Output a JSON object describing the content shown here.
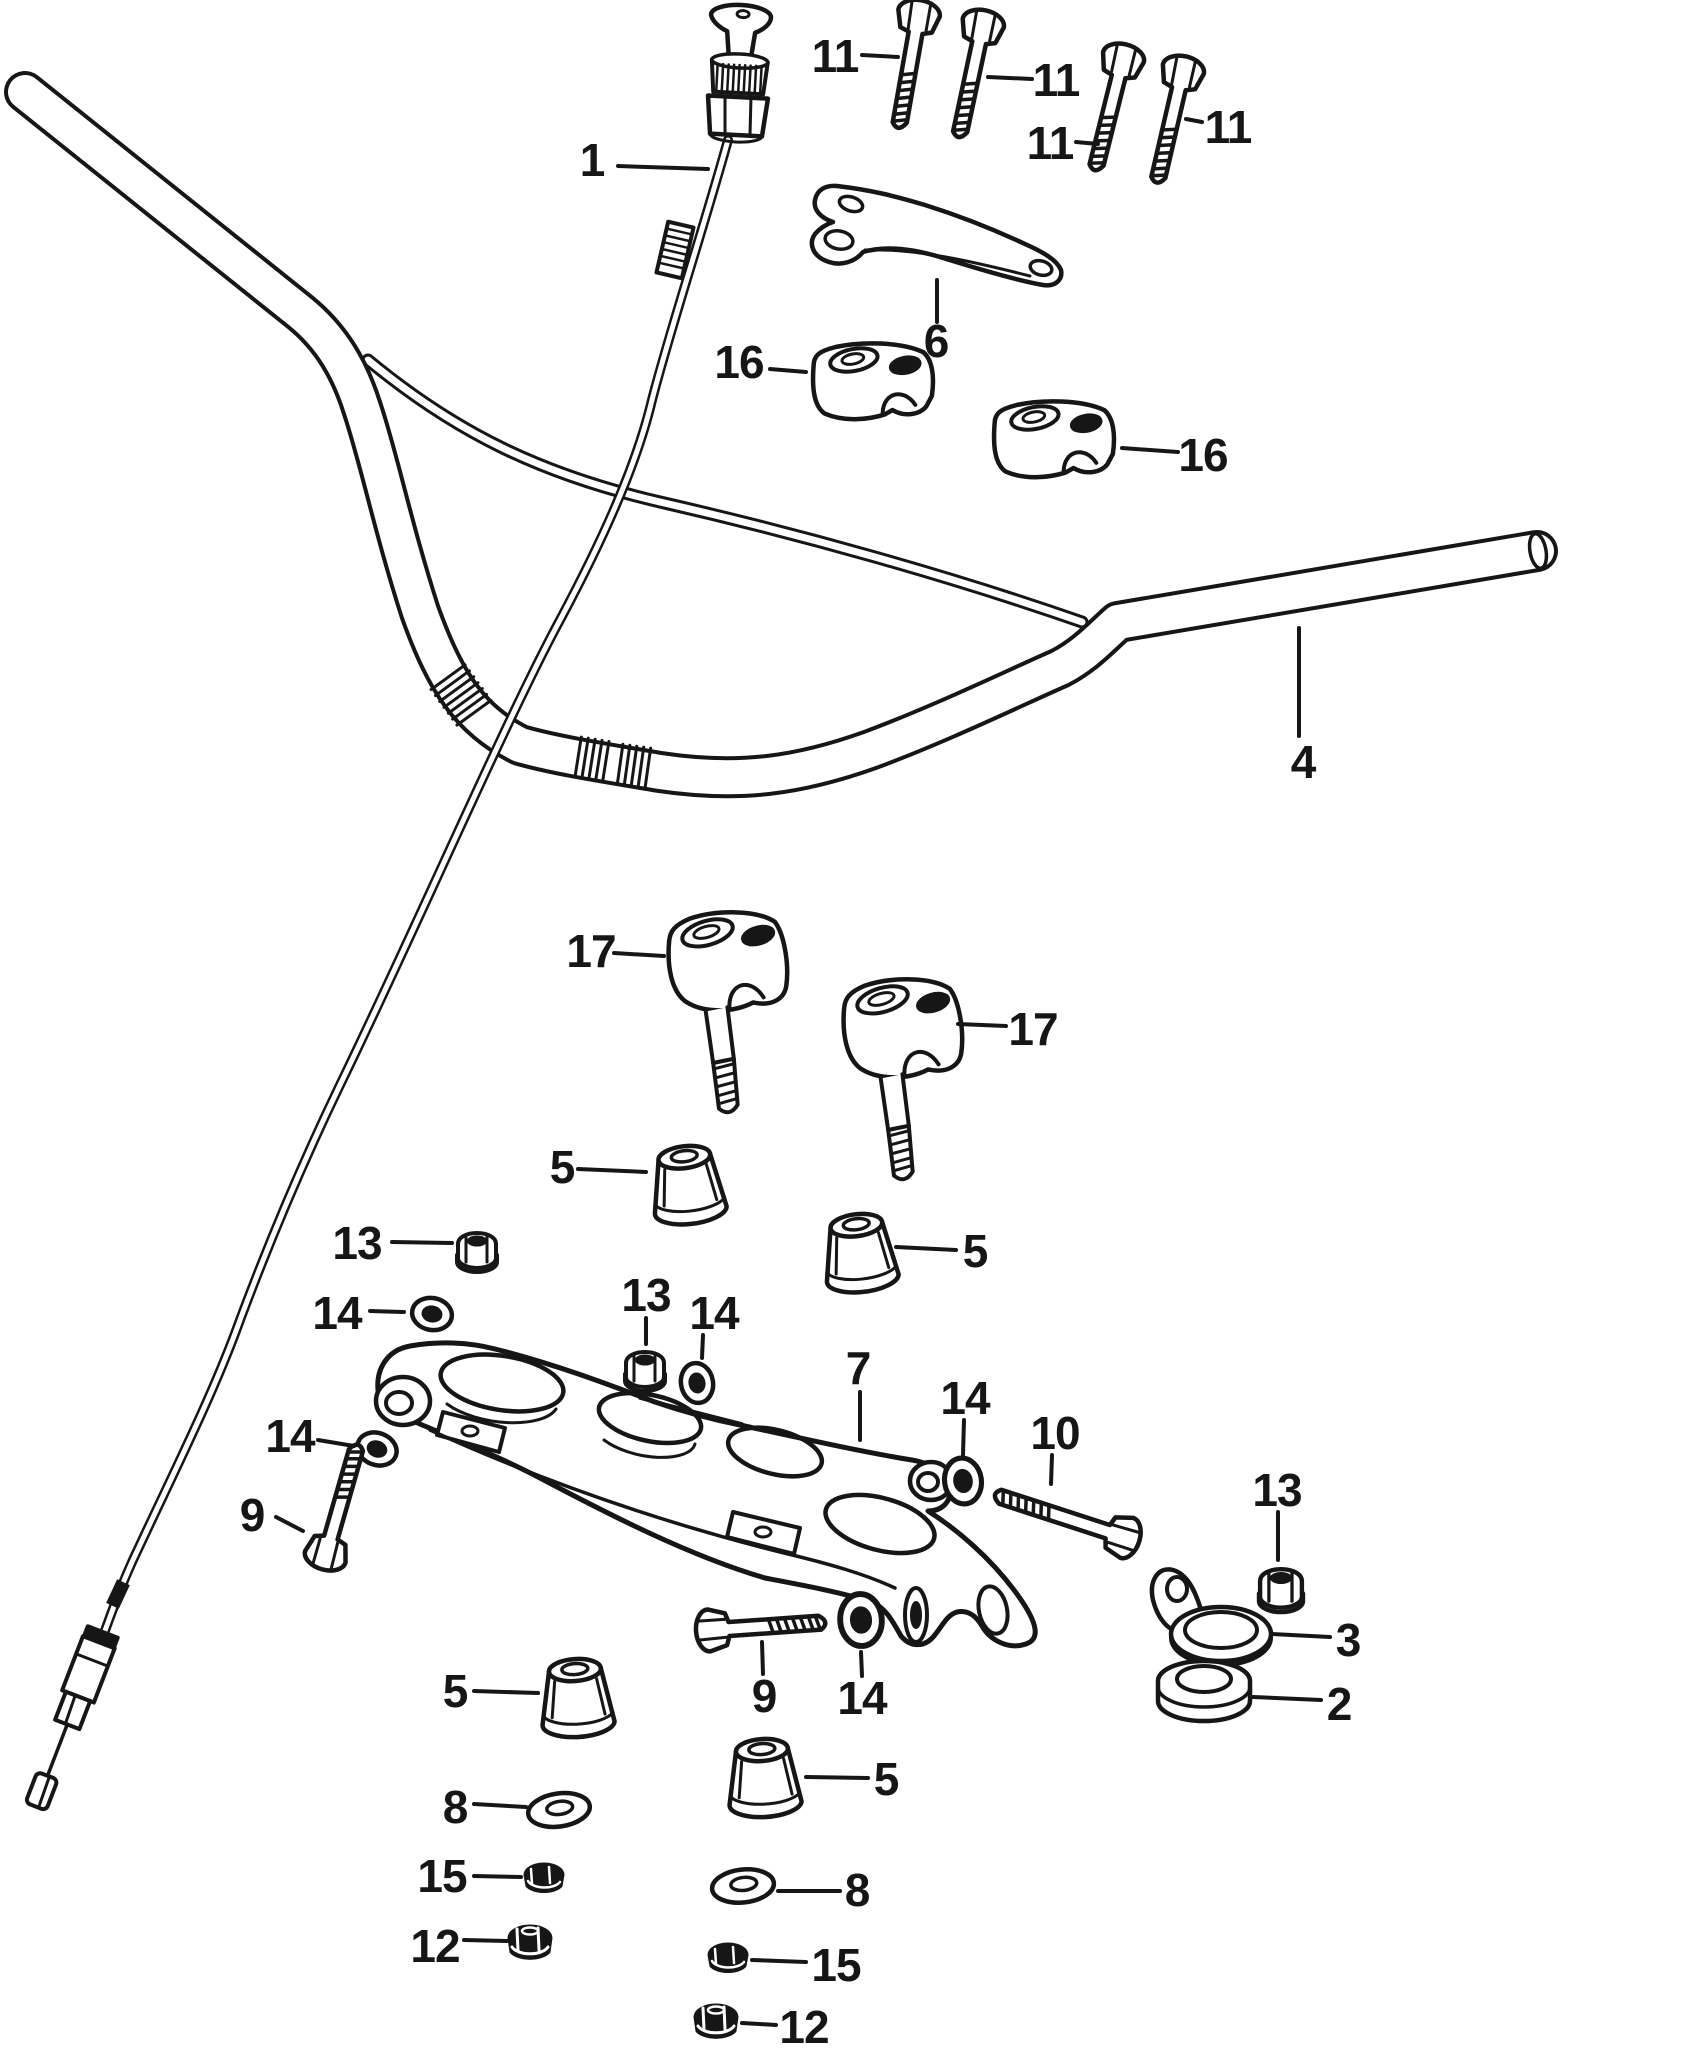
{
  "diagram": {
    "type": "exploded-parts-diagram",
    "subject": "motorcycle handlebar assembly",
    "canvas": {
      "width": 1700,
      "height": 2053,
      "background": "#ffffff",
      "ink": "#161616"
    },
    "label_style": {
      "font_size": 46,
      "font_weight": "bold",
      "leader_width": 4
    },
    "part_numbers_visible": [
      "1",
      "2",
      "3",
      "4",
      "5",
      "6",
      "7",
      "8",
      "9",
      "10",
      "11",
      "12",
      "13",
      "14",
      "15",
      "16",
      "17"
    ],
    "labels": [
      {
        "part": "1",
        "x": 592,
        "y": 160,
        "leader": [
          618,
          166,
          708,
          169
        ]
      },
      {
        "part": "11",
        "x": 835,
        "y": 56,
        "leader": [
          862,
          55,
          898,
          57
        ]
      },
      {
        "part": "11",
        "x": 1056,
        "y": 80,
        "leader": [
          1032,
          79,
          988,
          77
        ]
      },
      {
        "part": "11",
        "x": 1050,
        "y": 143,
        "leader": [
          1076,
          142,
          1098,
          144
        ]
      },
      {
        "part": "11",
        "x": 1228,
        "y": 127,
        "leader": [
          1202,
          122,
          1186,
          119
        ]
      },
      {
        "part": "6",
        "x": 936,
        "y": 341,
        "leader": [
          937,
          322,
          937,
          280
        ]
      },
      {
        "part": "16",
        "x": 739,
        "y": 362,
        "leader": [
          770,
          369,
          806,
          372
        ]
      },
      {
        "part": "16",
        "x": 1203,
        "y": 455,
        "leader": [
          1178,
          452,
          1122,
          448
        ]
      },
      {
        "part": "4",
        "x": 1303,
        "y": 762,
        "leader": [
          1299,
          736,
          1299,
          628
        ]
      },
      {
        "part": "17",
        "x": 591,
        "y": 951,
        "leader": [
          614,
          953,
          664,
          956
        ]
      },
      {
        "part": "17",
        "x": 1033,
        "y": 1029,
        "leader": [
          1006,
          1026,
          958,
          1024
        ]
      },
      {
        "part": "5",
        "x": 562,
        "y": 1167,
        "leader": [
          578,
          1169,
          646,
          1172
        ]
      },
      {
        "part": "5",
        "x": 975,
        "y": 1251,
        "leader": [
          956,
          1250,
          896,
          1247
        ]
      },
      {
        "part": "13",
        "x": 357,
        "y": 1243,
        "leader": [
          392,
          1242,
          452,
          1243
        ]
      },
      {
        "part": "14",
        "x": 337,
        "y": 1313,
        "leader": [
          370,
          1311,
          404,
          1312
        ]
      },
      {
        "part": "13",
        "x": 646,
        "y": 1295,
        "leader": [
          646,
          1318,
          646,
          1344
        ]
      },
      {
        "part": "14",
        "x": 714,
        "y": 1313,
        "leader": [
          703,
          1335,
          702,
          1358
        ]
      },
      {
        "part": "7",
        "x": 858,
        "y": 1368,
        "leader": [
          860,
          1392,
          860,
          1440
        ]
      },
      {
        "part": "14",
        "x": 965,
        "y": 1398,
        "leader": [
          964,
          1420,
          963,
          1455
        ]
      },
      {
        "part": "10",
        "x": 1055,
        "y": 1433,
        "leader": [
          1052,
          1455,
          1051,
          1484
        ]
      },
      {
        "part": "14",
        "x": 290,
        "y": 1436,
        "leader": [
          318,
          1440,
          354,
          1446
        ]
      },
      {
        "part": "9",
        "x": 252,
        "y": 1515,
        "leader": [
          276,
          1517,
          303,
          1531
        ]
      },
      {
        "part": "13",
        "x": 1277,
        "y": 1490,
        "leader": [
          1278,
          1512,
          1278,
          1560
        ]
      },
      {
        "part": "3",
        "x": 1348,
        "y": 1640,
        "leader": [
          1330,
          1637,
          1272,
          1634
        ]
      },
      {
        "part": "2",
        "x": 1339,
        "y": 1704,
        "leader": [
          1321,
          1700,
          1253,
          1697
        ]
      },
      {
        "part": "5",
        "x": 455,
        "y": 1691,
        "leader": [
          474,
          1691,
          538,
          1693
        ]
      },
      {
        "part": "9",
        "x": 764,
        "y": 1696,
        "leader": [
          763,
          1674,
          762,
          1642
        ]
      },
      {
        "part": "14",
        "x": 862,
        "y": 1698,
        "leader": [
          862,
          1676,
          861,
          1652
        ]
      },
      {
        "part": "5",
        "x": 886,
        "y": 1779,
        "leader": [
          868,
          1778,
          806,
          1777
        ]
      },
      {
        "part": "8",
        "x": 455,
        "y": 1807,
        "leader": [
          474,
          1804,
          526,
          1807
        ]
      },
      {
        "part": "8",
        "x": 857,
        "y": 1890,
        "leader": [
          840,
          1891,
          778,
          1891
        ]
      },
      {
        "part": "15",
        "x": 442,
        "y": 1876,
        "leader": [
          474,
          1876,
          521,
          1877
        ]
      },
      {
        "part": "15",
        "x": 836,
        "y": 1965,
        "leader": [
          806,
          1962,
          752,
          1960
        ]
      },
      {
        "part": "12",
        "x": 435,
        "y": 1946,
        "leader": [
          464,
          1940,
          507,
          1941
        ]
      },
      {
        "part": "12",
        "x": 804,
        "y": 2027,
        "leader": [
          776,
          2025,
          742,
          2023
        ]
      }
    ]
  }
}
